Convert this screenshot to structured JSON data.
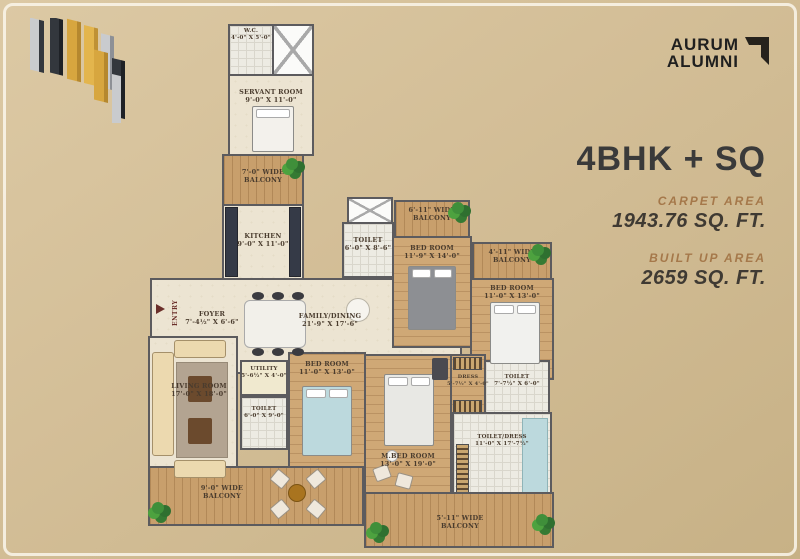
{
  "colors": {
    "background_tan": "#d4bf98",
    "accent_brown": "#a5784a",
    "title_dark": "#3a3a3a",
    "gold": "#d7a63f",
    "wall_gray": "#5c5b5e",
    "wood": "#cfa876"
  },
  "brand": {
    "line1": "AURUM",
    "line2": "ALUMNI"
  },
  "info": {
    "title": "4BHK + SQ",
    "carpet_label": "CARPET AREA",
    "carpet_value": "1943.76 SQ. FT.",
    "builtup_label": "BUILT UP AREA",
    "builtup_value": "2659 SQ. FT."
  },
  "floorplan": {
    "entry_label": "ENTRY",
    "rooms": {
      "wc": {
        "line1": "W.C.",
        "line2": "4'-0\" X 5'-0\""
      },
      "servant": {
        "line1": "SERVANT ROOM",
        "line2": "9'-0\" X 11'-0\""
      },
      "balcony7": {
        "line1": "7'-0\" WIDE",
        "line2": "BALCONY"
      },
      "kitchen": {
        "line1": "KITCHEN",
        "line2": "9'-0\" X 11'-0\""
      },
      "foyer": {
        "line1": "FOYER",
        "line2": "7'-4½\" X 6'-6\""
      },
      "family": {
        "line1": "FAMILY/DINING",
        "line2": "21'-9\" X 17'-6\""
      },
      "toilet_top": {
        "line1": "TOILET",
        "line2": "6'-0\" X 8'-6\""
      },
      "balcony611": {
        "line1": "6'-11\" WIDE",
        "line2": "BALCONY"
      },
      "bed_tr": {
        "line1": "BED ROOM",
        "line2": "11'-9\" X 14'-0\""
      },
      "balcony411": {
        "line1": "4'-11\" WIDE",
        "line2": "BALCONY"
      },
      "bed_r": {
        "line1": "BED ROOM",
        "line2": "11'-0\" X 13'-0\""
      },
      "living": {
        "line1": "LIVING ROOM",
        "line2": "17'-0\" X 18'-0\""
      },
      "utility": {
        "line1": "UTILITY",
        "line2": "5'-6½\" X 4'-0\""
      },
      "toilet_l": {
        "line1": "TOILET",
        "line2": "6'-0\" X 9'-0\""
      },
      "bed_c": {
        "line1": "BED ROOM",
        "line2": "11'-0\" X 13'-0\""
      },
      "dress": {
        "line1": "DRESS",
        "line2": "5'-7½\" X 4'-0\""
      },
      "toilet_r": {
        "line1": "TOILET",
        "line2": "7'-7½\" X 6'-0\""
      },
      "mbed": {
        "line1": "M.BED ROOM",
        "line2": "13'-0\" X 19'-0\""
      },
      "toiletdress": {
        "line1": "TOILET/DRESS",
        "line2": "11'-0\" X 17'-7½\""
      },
      "balcony9": {
        "line1": "9'-0\" WIDE",
        "line2": "BALCONY"
      },
      "balcony511": {
        "line1": "5'-11\" WIDE",
        "line2": "BALCONY"
      }
    }
  }
}
